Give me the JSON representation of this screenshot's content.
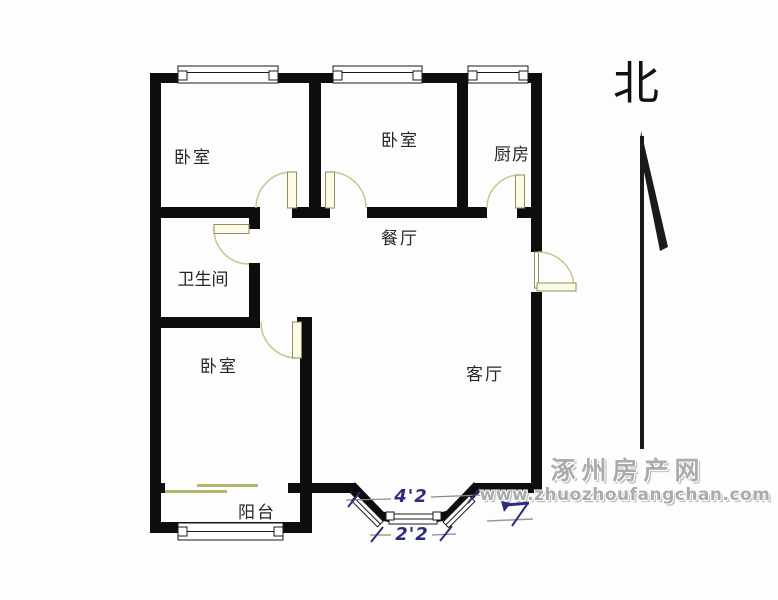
{
  "compass": {
    "label": "北"
  },
  "rooms": [
    {
      "id": "bedroom-northwest",
      "label": "卧室"
    },
    {
      "id": "bedroom-north",
      "label": "卧室"
    },
    {
      "id": "kitchen",
      "label": "厨房"
    },
    {
      "id": "dining-room",
      "label": "餐厅"
    },
    {
      "id": "bathroom",
      "label": "卫生间"
    },
    {
      "id": "bedroom-southwest",
      "label": "卧室"
    },
    {
      "id": "living-room",
      "label": "客厅"
    },
    {
      "id": "balcony",
      "label": "阳台"
    }
  ],
  "dimensions": [
    {
      "id": "bay-window-outer-width",
      "label": "4'2"
    },
    {
      "id": "bay-window-inner-width",
      "label": "2'2"
    }
  ],
  "watermark": {
    "site_name": "涿州房产网",
    "site_url": "www.zhuozhoufangchan.com"
  },
  "colors": {
    "wall": "#0d0d0d",
    "window_line": "#1a1a1a",
    "door_leaf_fill": "#fdfbe8",
    "door_outline": "#8f8f5a",
    "door_arc": "#c6c68e",
    "sliding_door": "#b5b56e",
    "dimension_text": "#2d2d7f",
    "dimension_line": "#8a8a8a",
    "watermark_text": "#ababab",
    "background": "#fdfdfd"
  }
}
